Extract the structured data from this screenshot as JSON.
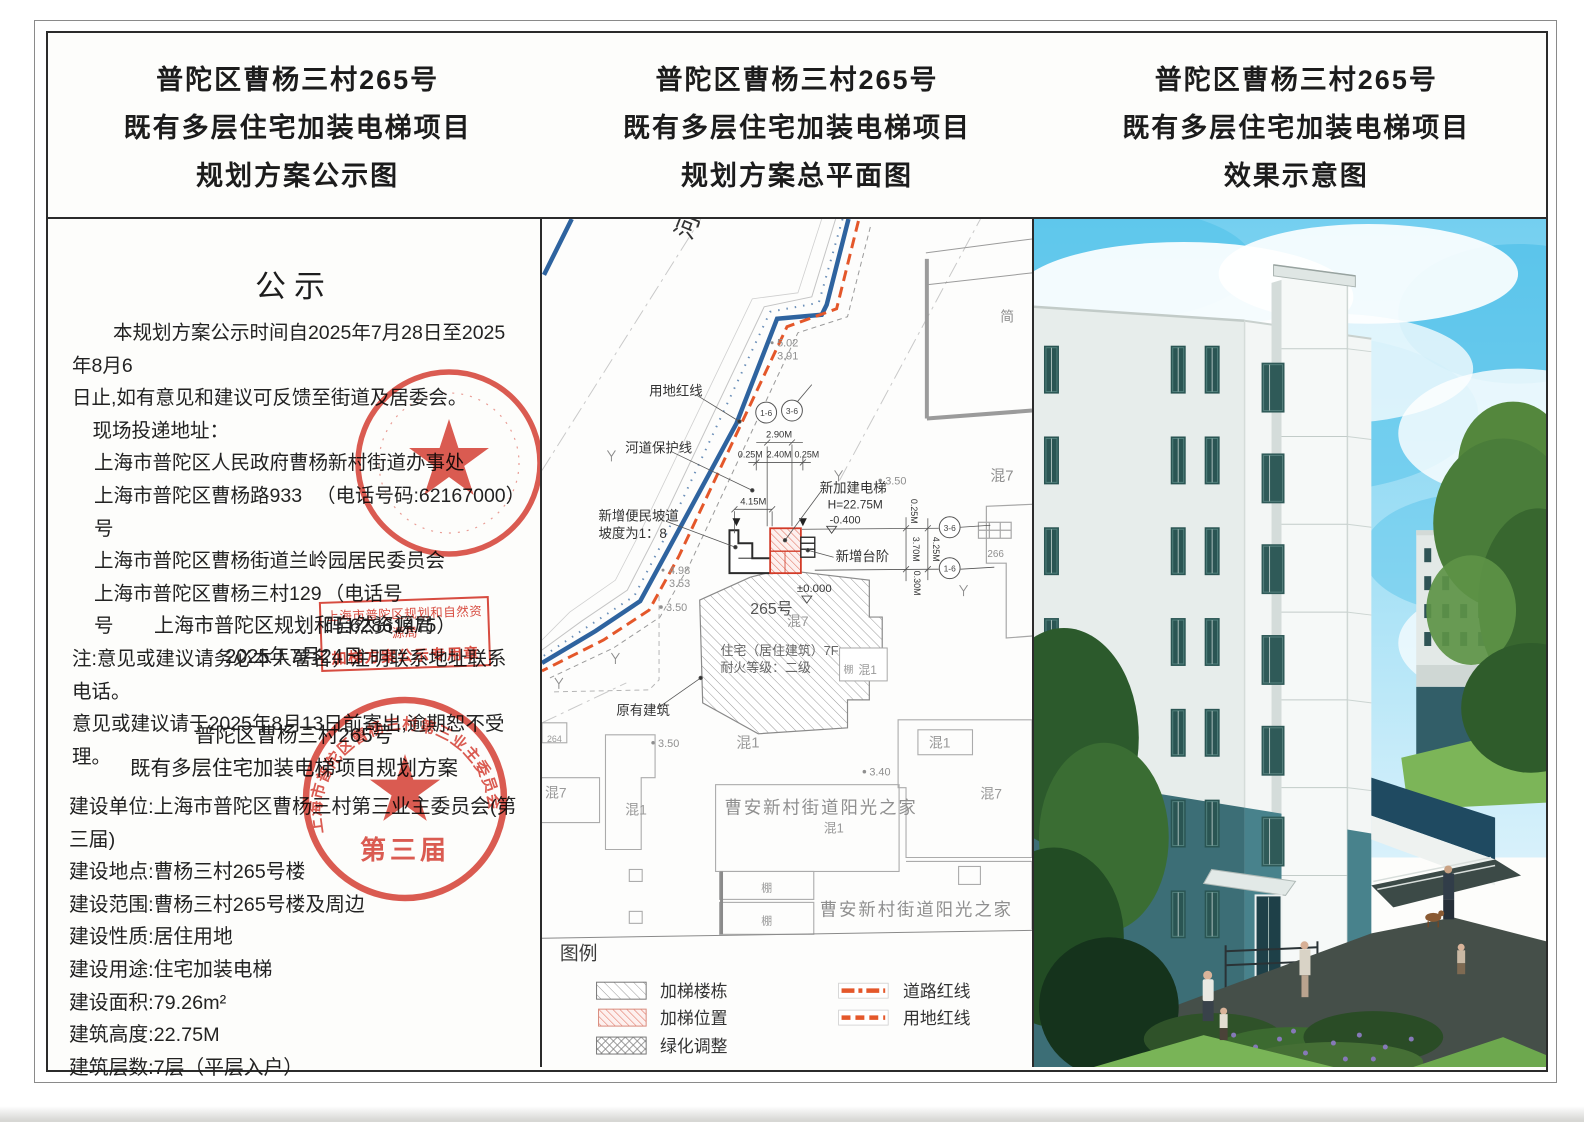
{
  "titles": {
    "left": [
      "普陀区曹杨三村265号",
      "既有多层住宅加装电梯项目",
      "规划方案公示图"
    ],
    "middle": [
      "普陀区曹杨三村265号",
      "既有多层住宅加装电梯项目",
      "规划方案总平面图"
    ],
    "right": [
      "普陀区曹杨三村265号",
      "既有多层住宅加装电梯项目",
      "效果示意图"
    ]
  },
  "notice": {
    "heading": "公示",
    "para": [
      "本规划方案公示时间自2025年7月28日至2025年8月6",
      "日止,如有意见和建议可反馈至街道及居委会。",
      "现场投递地址："
    ],
    "addresses": [
      {
        "name": "上海市普陀区人民政府曹杨新村街道办事处",
        "phone": ""
      },
      {
        "name": "上海市普陀区曹杨路933号",
        "phone": "（电话号码:62167000）"
      },
      {
        "name": "上海市普陀区曹杨街道兰岭园居民委员会",
        "phone": ""
      },
      {
        "name": "上海市普陀区曹杨三村129号",
        "phone": "（电话号码:62861475）"
      }
    ],
    "notes": [
      "注:意见或建议请务必本人署名，注明联系地址联系电话。",
      "意见或建议请于2025年8月13日前寄出,逾期恕不受理。"
    ],
    "authority": "上海市普陀区规划和自然资源局",
    "date": "2025年7月24日",
    "stamp_box": [
      "上海市普陀区规划和自然资源局",
      "加梯方案公示专用章"
    ],
    "seal_ring_text": "上海市普陀区曹杨三村第三业主委员会",
    "seal_term": "第三届"
  },
  "project": {
    "title_lines": [
      "普陀区曹杨三村265号",
      "既有多层住宅加装电梯项目规划方案"
    ],
    "items": [
      "建设单位:上海市普陀区曹杨三村第三业主委员会(第三届)",
      "建设地点:曹杨三村265号楼",
      "建设范围:曹杨三村265号楼及周边",
      "建设性质:居住用地",
      "建设用途:住宅加装电梯",
      "建设面积:79.26m²",
      "建筑高度:22.75M",
      "建筑层数:7层（平层入户）"
    ]
  },
  "plan": {
    "labels": {
      "river": "河",
      "land_redline": "用地红线",
      "river_protect": "河道保护线",
      "ramp1": "新增便民坡道",
      "ramp2": "坡度为1：8",
      "new_elevator": "新加建电梯",
      "elev_h": "H=22.75M",
      "elev_neg": "-0.400",
      "new_steps": "新增台阶",
      "zero": "±0.000",
      "bld265": "265号",
      "hun7": "混7",
      "hun1": "混1",
      "residence": "住宅（居住建筑）7F",
      "fire": "耐火等级：二级",
      "existing": "原有建筑",
      "jian": "简",
      "n266": "266",
      "n264": "264",
      "shed": "棚",
      "sunshine": "曹安新村街道阳光之家"
    },
    "elevations": {
      "e502": "5.02",
      "e391": "3.91",
      "e498": "4.98",
      "e353": "3.53",
      "e350": "3.50",
      "e340": "3.40"
    },
    "dims": {
      "d290": "2.90M",
      "d025": "0.25M",
      "d240": "2.40M",
      "d415": "4.15M",
      "d370": "3.70M",
      "d030": "0.30M",
      "d425": "4.25M"
    },
    "axes": {
      "a36": "3-6",
      "a16": "1-6"
    },
    "legend": {
      "title": "图例",
      "col1": [
        "加梯楼栋",
        "加梯位置",
        "绿化调整"
      ],
      "col2": [
        "道路红线",
        "用地红线"
      ]
    }
  },
  "colors": {
    "redline_orange": "#e4572a",
    "river_blue": "#2e639f",
    "seal_red": "#d5382c",
    "elevator_red": "#d23b28",
    "ink": "#2b2b2b"
  }
}
